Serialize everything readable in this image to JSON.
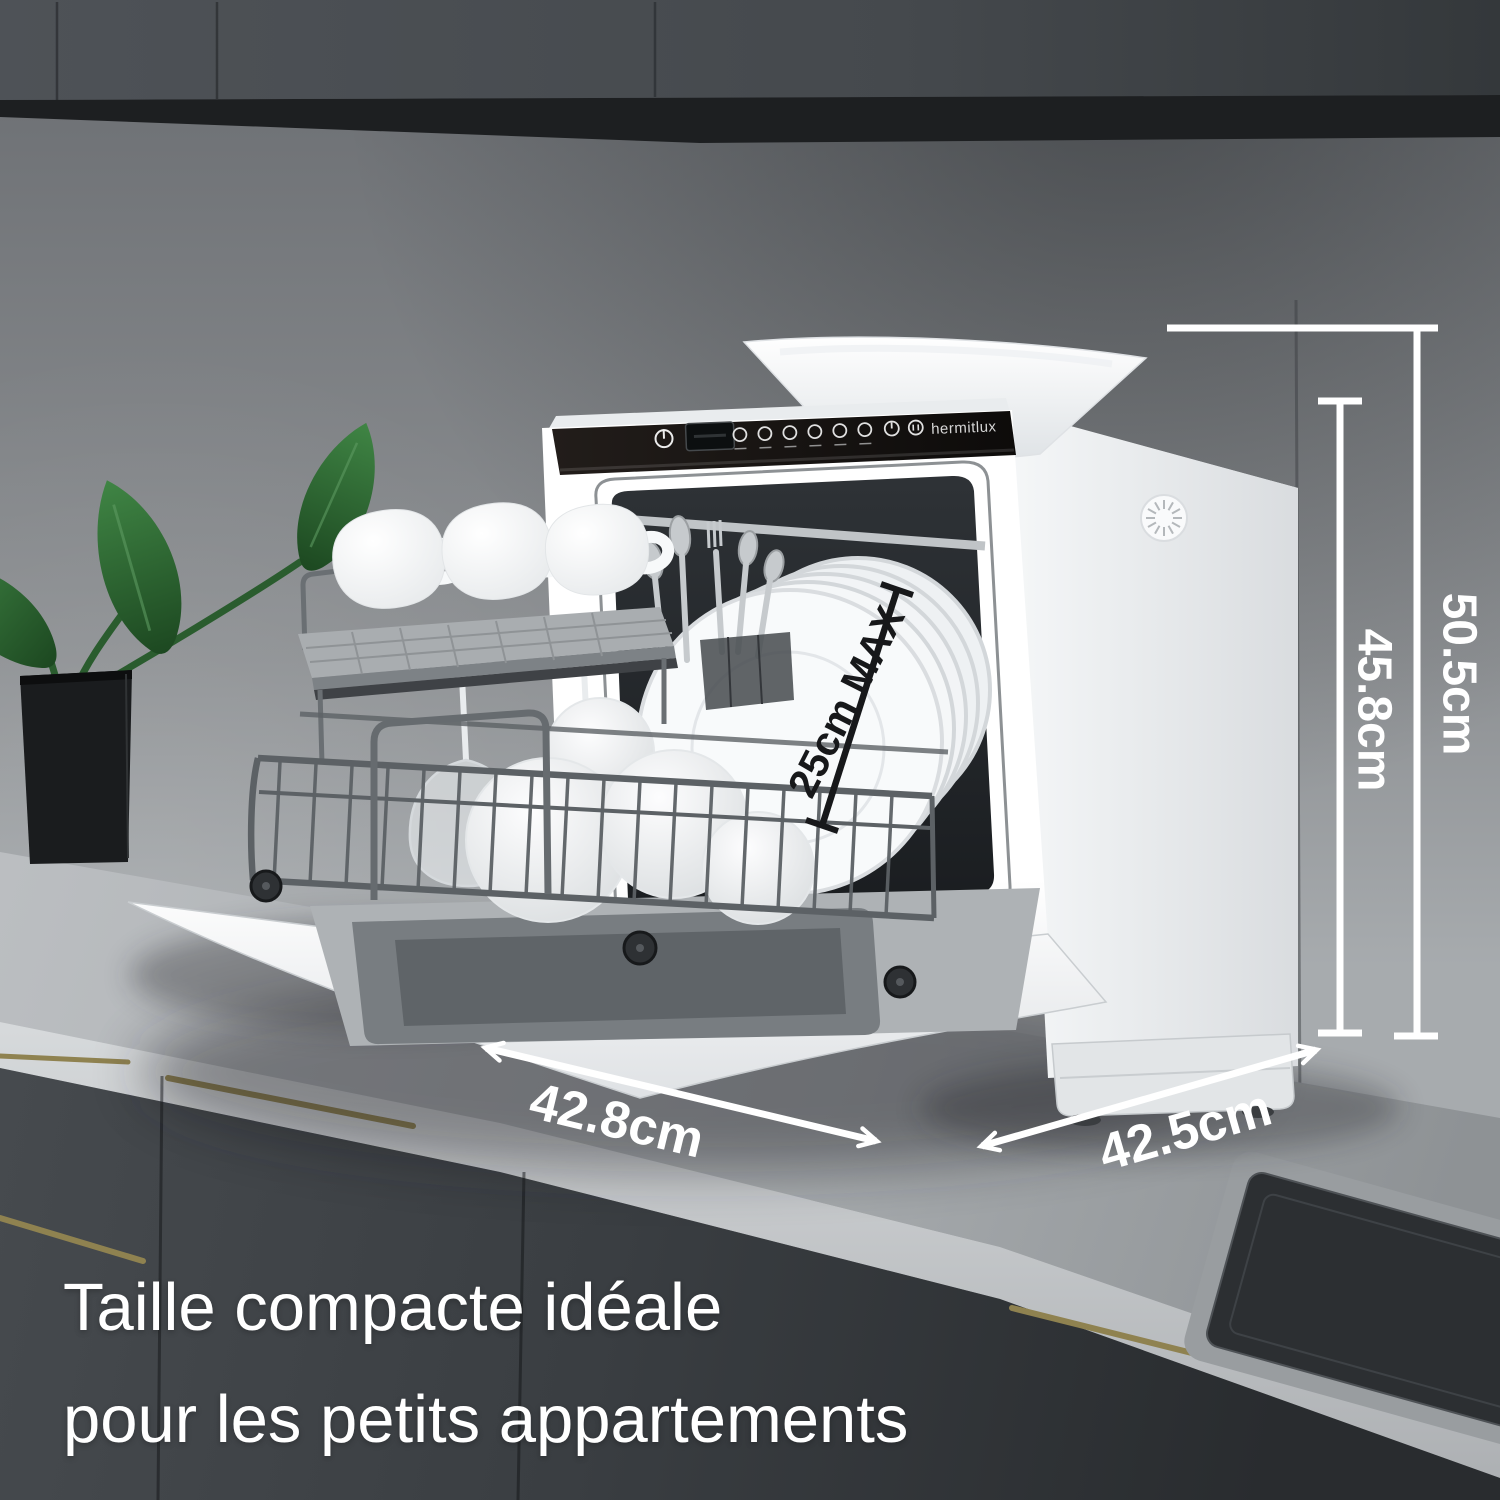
{
  "scene": {
    "appliance": {
      "brand": "hermitlux",
      "panel_icons": [
        "power-icon",
        "lcd-display",
        "program-icon-1",
        "program-icon-2",
        "program-icon-3",
        "program-icon-4",
        "program-icon-5",
        "program-icon-6",
        "delay-icon",
        "start-pause-icon"
      ]
    },
    "annotations": {
      "total_height": "50.5cm",
      "body_height": "45.8cm",
      "front_width": "42.8cm",
      "side_depth": "42.5cm",
      "plate_max": "25cm MAX"
    },
    "caption": {
      "line1": "Taille compacte idéale",
      "line2": "pour les petits appartements"
    },
    "colors": {
      "annotation_white": "#ffffff",
      "annotation_black": "#17181a",
      "caption_text": "#ffffff",
      "handle_gold": "#8f8250",
      "leaf_green": "#2f6b33",
      "panel_black": "#161210",
      "appliance_body": "#f2f4f6"
    }
  }
}
